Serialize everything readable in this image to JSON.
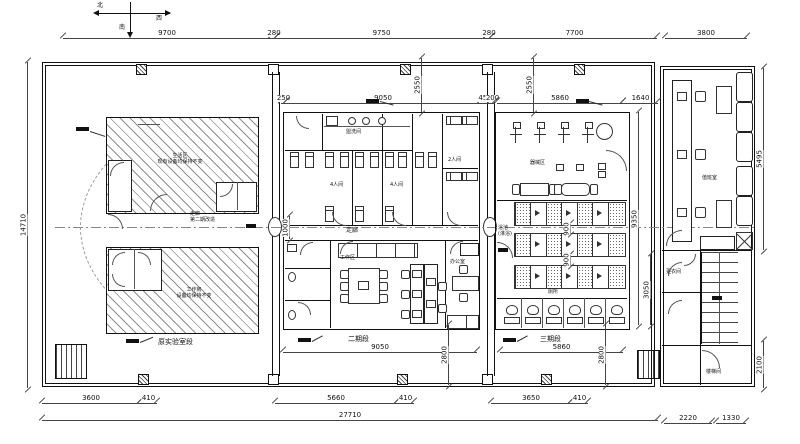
{
  "compass": {
    "n": "北",
    "w": "西",
    "s": "南"
  },
  "dims": {
    "top": [
      "9700",
      "280",
      "9750",
      "280",
      "7700",
      "3800"
    ],
    "left_total": "14710",
    "mid_top": [
      "250",
      "9050",
      "450"
    ],
    "right_top": [
      "200",
      "5860",
      "1640"
    ],
    "v2550a": "2550",
    "v2550b": "2550",
    "corridor": "1000",
    "right_side": [
      "9350",
      "3050"
    ],
    "annex_side": [
      "5495",
      "2100"
    ],
    "mid_bottom": [
      "9050",
      "2800"
    ],
    "right_bottom": [
      "5860",
      "2800"
    ],
    "bottom1": [
      "3600",
      "410",
      "5660",
      "410",
      "3650",
      "410"
    ],
    "total": "27710",
    "annex_bottom": [
      "2220",
      "1330"
    ],
    "stall_gap_a": "900",
    "stall_gap_b": "900"
  },
  "labels": {
    "room_upper_1": "生活区",
    "room_upper_2": "现有设备均保持不变",
    "room_lower_1": "工作房",
    "room_lower_2": "设备均保持不变",
    "section_left": "原实验室段",
    "section_mid": "二期段",
    "section_right": "三期段",
    "corridor": "走廊",
    "corridor_note1": "走廊",
    "corridor_note2": "第二期改造",
    "washroom": "盥洗间",
    "room4a": "4人间",
    "room4b": "4人间",
    "room2": "2人间",
    "meeting": "工作区",
    "office": "办公室",
    "equipment": "器械区",
    "bath1": "浴池",
    "bath2": "(淋浴)",
    "toilet": "厕所",
    "annex_room": "值班室",
    "dressing": "更衣间",
    "stair2": "楼梯间"
  }
}
